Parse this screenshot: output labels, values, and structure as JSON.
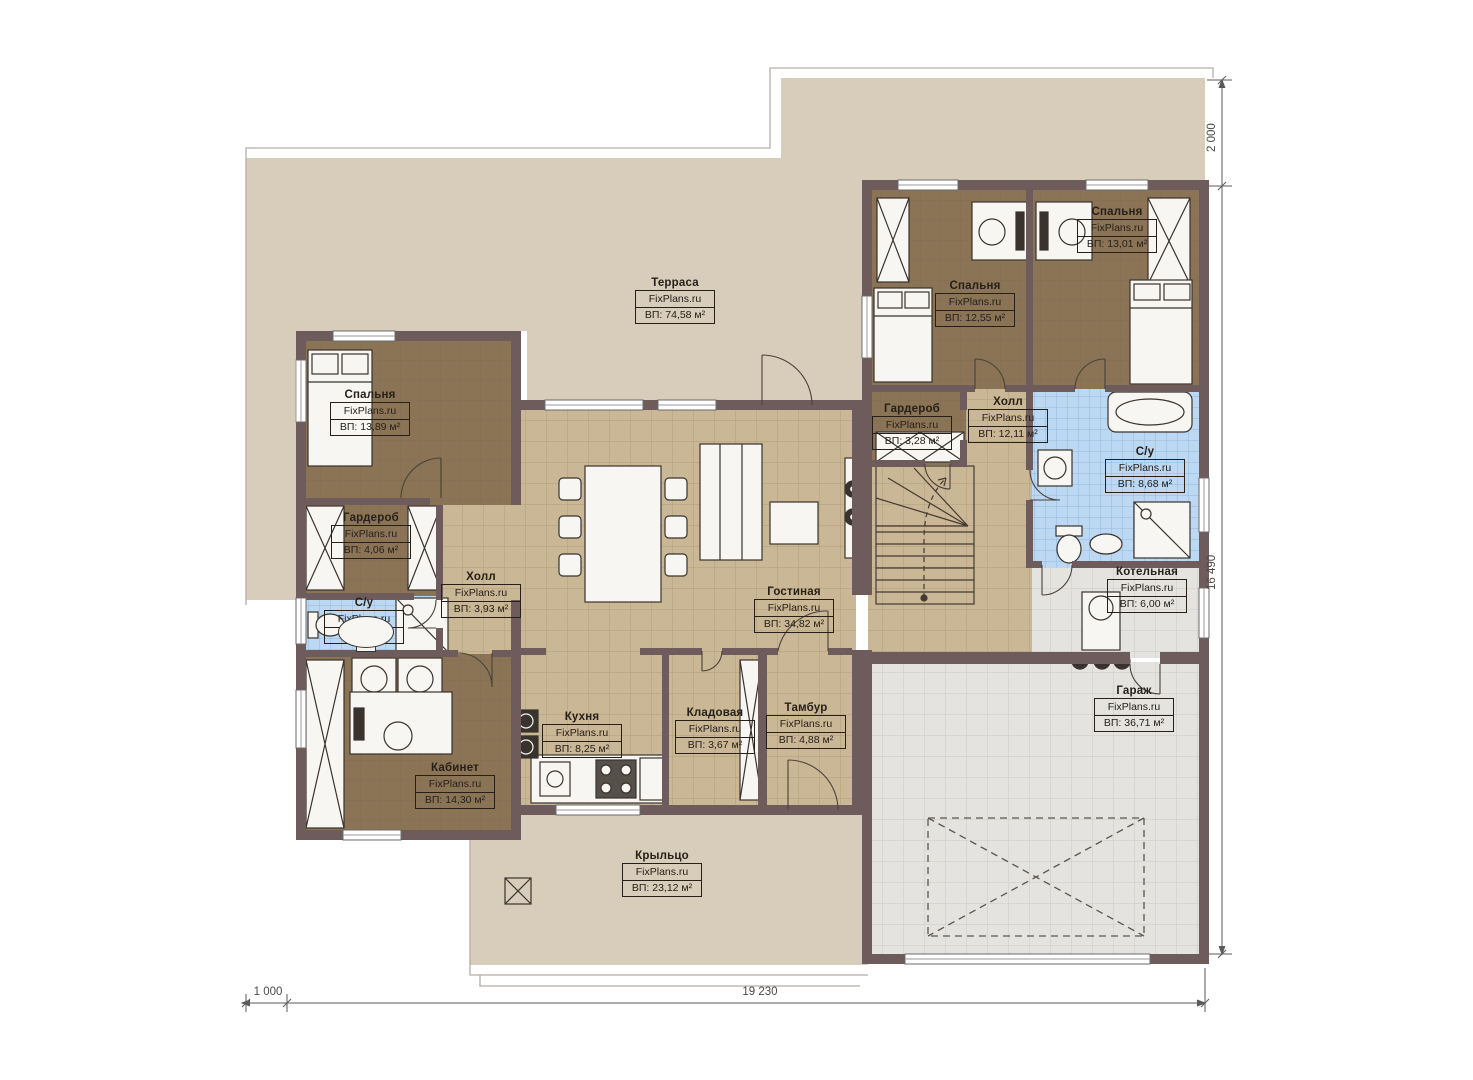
{
  "brand": "FixPlans.ru",
  "rooms": [
    {
      "name": "Терраса",
      "brand": "FixPlans.ru",
      "area": "ВП: 74,58 м²"
    },
    {
      "name": "Спальня",
      "brand": "FixPlans.ru",
      "area": "ВП: 13,89 м²"
    },
    {
      "name": "Гардероб",
      "brand": "FixPlans.ru",
      "area": "ВП: 4,06 м²"
    },
    {
      "name": "С/у",
      "brand": "FixPlans.ru",
      "area": "ВП:"
    },
    {
      "name": "Холл",
      "brand": "FixPlans.ru",
      "area": "ВП: 3,93 м²"
    },
    {
      "name": "Кухня",
      "brand": "FixPlans.ru",
      "area": "ВП: 8,25 м²"
    },
    {
      "name": "Кабинет",
      "brand": "FixPlans.ru",
      "area": "ВП: 14,30 м²"
    },
    {
      "name": "Кладовая",
      "brand": "FixPlans.ru",
      "area": "ВП: 3,67 м²"
    },
    {
      "name": "Тамбур",
      "brand": "FixPlans.ru",
      "area": "ВП: 4,88 м²"
    },
    {
      "name": "Гостиная",
      "brand": "FixPlans.ru",
      "area": "ВП: 34,82 м²"
    },
    {
      "name": "Гардероб",
      "brand": "FixPlans.ru",
      "area": "ВП: 3,28 м²"
    },
    {
      "name": "Холл",
      "brand": "FixPlans.ru",
      "area": "ВП: 12,11 м²"
    },
    {
      "name": "Спальня",
      "brand": "FixPlans.ru",
      "area": "ВП: 12,55 м²"
    },
    {
      "name": "Спальня",
      "brand": "FixPlans.ru",
      "area": "ВП: 13,01 м²"
    },
    {
      "name": "С/у",
      "brand": "FixPlans.ru",
      "area": "ВП: 8,68 м²"
    },
    {
      "name": "Котельная",
      "brand": "FixPlans.ru",
      "area": "ВП: 6,00 м²"
    },
    {
      "name": "Гараж",
      "brand": "FixPlans.ru",
      "area": "ВП: 36,71 м²"
    },
    {
      "name": "Крыльцо",
      "brand": "FixPlans.ru",
      "area": "ВП: 23,12 м²"
    }
  ],
  "dimensions": {
    "top_right": "2 000",
    "right_side": "16 490",
    "bottom_left": "1 000",
    "bottom_main": "19 230"
  },
  "colors": {
    "wall": "#6e5c5c",
    "terrace": "#d8ccba",
    "floor_tan": "#c9b795",
    "floor_brown": "#8b7456",
    "tile_blue": "#bcd8f2",
    "tile_gray": "#e4e3e0"
  }
}
